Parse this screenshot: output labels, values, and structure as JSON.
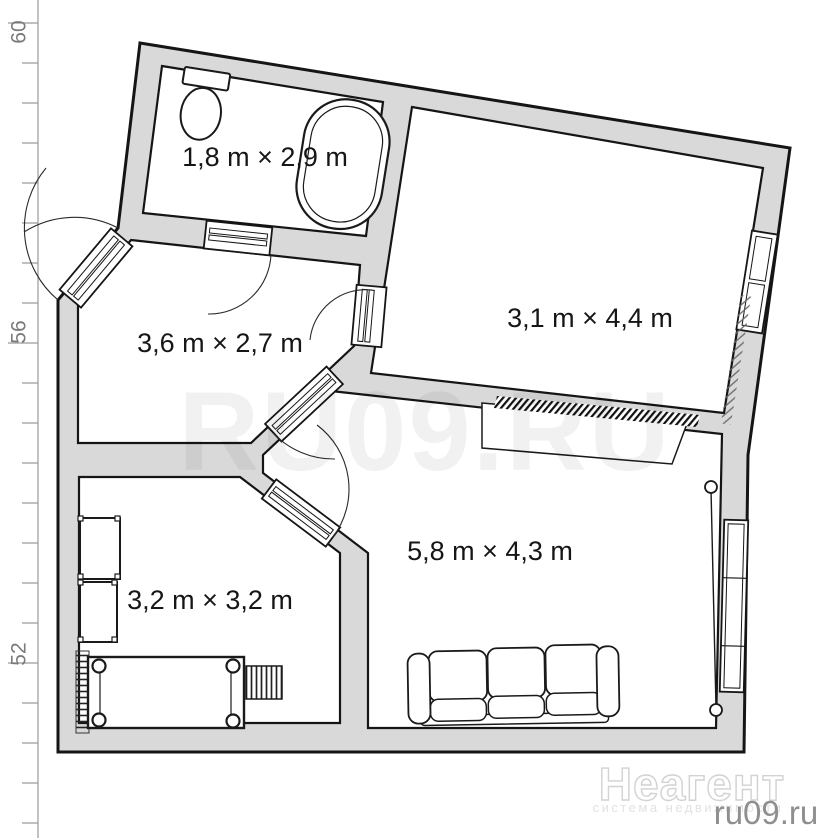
{
  "plan": {
    "type": "apartment-floor-plan",
    "units": "m",
    "rooms": [
      {
        "id": "bathroom",
        "label": "1,8 m × 2,9 m",
        "width_m": "1,8",
        "length_m": "2,9"
      },
      {
        "id": "room-top-right",
        "label": "3,1 m × 4,4 m",
        "width_m": "3,1",
        "length_m": "4,4"
      },
      {
        "id": "hallway",
        "label": "3,6 m × 2,7 m",
        "width_m": "3,6",
        "length_m": "2,7"
      },
      {
        "id": "bedroom",
        "label": "3,2 m × 3,2 m",
        "width_m": "3,2",
        "length_m": "3,2"
      },
      {
        "id": "living-room",
        "label": "5,8 m × 4,3 m",
        "width_m": "5,8",
        "length_m": "4,3"
      }
    ],
    "furniture": [
      "toilet",
      "bathtub",
      "bed",
      "radiator",
      "wardrobe",
      "wardrobe",
      "ladder",
      "sofa",
      "table",
      "hatched-counter",
      "curtain-rod",
      "window",
      "window"
    ],
    "doors": [
      "entry-door",
      "bathroom-door",
      "room-top-right-door",
      "living-room-door",
      "bedroom-door"
    ]
  },
  "ruler": {
    "labels": [
      "60",
      "56",
      "52"
    ]
  },
  "watermarks": {
    "center": "RU09.RU",
    "brand": "Неагент",
    "brand_subtitle": "система недвижимости",
    "site": "ru09.ru"
  },
  "colors": {
    "wall_fill": "#d9d9d9",
    "line": "#151515",
    "watermark": "rgba(0,0,0,0.055)",
    "ruler": "#8a8a8a"
  }
}
